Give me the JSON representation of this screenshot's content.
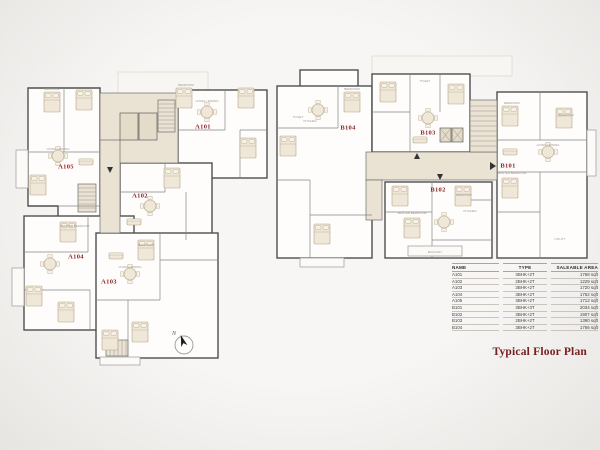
{
  "title": "Typical Floor Plan",
  "compass": {
    "north_label": "N"
  },
  "units": [
    {
      "label": "A101"
    },
    {
      "label": "A102"
    },
    {
      "label": "A103"
    },
    {
      "label": "A104"
    },
    {
      "label": "A105"
    },
    {
      "label": "B101"
    },
    {
      "label": "B102"
    },
    {
      "label": "B103"
    },
    {
      "label": "B104"
    }
  ],
  "room_labels": [
    "BEDROOM",
    "MASTER BEDROOM",
    "LIVING / DINING",
    "KITCHEN",
    "TOILET",
    "UTILITY",
    "BALCONY"
  ],
  "table": {
    "columns": [
      "NAME",
      "TYPE",
      "SALEABLE AREA"
    ],
    "rows": [
      {
        "name": "A101",
        "type": "3BHK+2T",
        "area": "1768 sqft"
      },
      {
        "name": "A102",
        "type": "2BHK+2T",
        "area": "1229 sqft"
      },
      {
        "name": "A103",
        "type": "3BHK+2T",
        "area": "1720 sqft"
      },
      {
        "name": "A104",
        "type": "3BHK+2T",
        "area": "1752 sqft"
      },
      {
        "name": "A105",
        "type": "3BHK+2T",
        "area": "1712 sqft"
      },
      {
        "name": "B101",
        "type": "3BHK+3T",
        "area": "2034 sqft"
      },
      {
        "name": "B102",
        "type": "3BHK+2T",
        "area": "1907 sqft"
      },
      {
        "name": "B103",
        "type": "2BHK+2T",
        "area": "1390 sqft"
      },
      {
        "name": "B104",
        "type": "3BHK+2T",
        "area": "1766 sqft"
      }
    ]
  },
  "colors": {
    "unit_label": "#8e2323",
    "title": "#772020",
    "wall": "#4f4f4f",
    "corridor": "#eae2d2",
    "furniture": "#efe7d7",
    "background": "#f4f3f1"
  }
}
